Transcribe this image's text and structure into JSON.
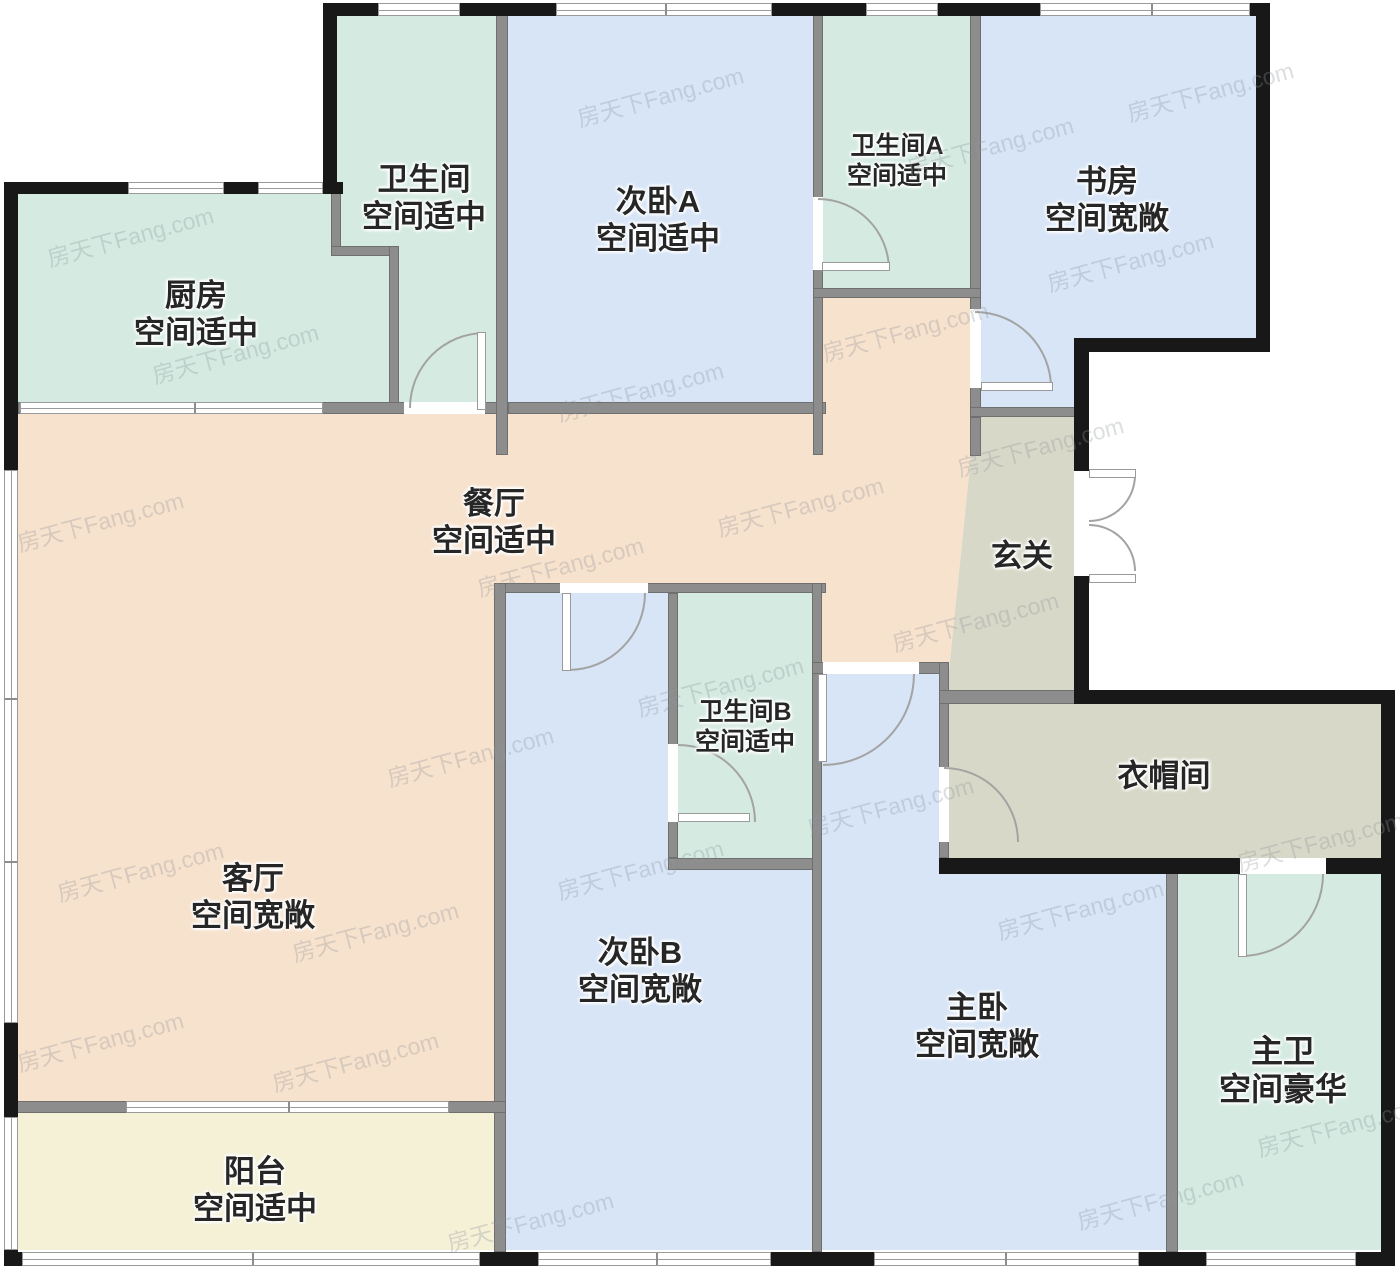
{
  "app": {
    "type": "residential-floor-plan",
    "watermark_text": "房天下Fang.com"
  },
  "canvas": {
    "w": 1400,
    "h": 1269,
    "bg": "#ffffff"
  },
  "palette": {
    "mint": "#d5ebe2",
    "blue": "#d7e5f7",
    "peach": "#f7e2cd",
    "yellow": "#f4f1d7",
    "gray": "#d8d8c8",
    "wall_black": "#181818",
    "wall_gray": "#8d8d8d",
    "door_arc": "#a3a3a3",
    "label_color": "#262626",
    "watermark_color": "#8f959b"
  },
  "regions": [
    {
      "id": "kitchen",
      "color": "mint",
      "kind": "rect",
      "x": 18,
      "y": 192,
      "w": 371,
      "h": 220
    },
    {
      "id": "bathroom-top",
      "color": "mint",
      "kind": "poly",
      "points": [
        [
          337,
          14
        ],
        [
          496,
          14
        ],
        [
          496,
          412
        ],
        [
          399,
          412
        ],
        [
          399,
          251
        ],
        [
          337,
          251
        ]
      ]
    },
    {
      "id": "bedroom-a",
      "color": "blue",
      "kind": "rect",
      "x": 508,
      "y": 16,
      "w": 305,
      "h": 396
    },
    {
      "id": "bathroom-a",
      "color": "mint",
      "kind": "rect",
      "x": 823,
      "y": 16,
      "w": 147,
      "h": 276
    },
    {
      "id": "study",
      "color": "blue",
      "kind": "poly",
      "points": [
        [
          981,
          16
        ],
        [
          1256,
          16
        ],
        [
          1256,
          338
        ],
        [
          1074,
          338
        ],
        [
          1074,
          409
        ],
        [
          981,
          409
        ]
      ]
    },
    {
      "id": "living-dining",
      "color": "peach",
      "kind": "poly",
      "points": [
        [
          18,
          412
        ],
        [
          823,
          412
        ],
        [
          823,
          298
        ],
        [
          975,
          298
        ],
        [
          975,
          417
        ],
        [
          949,
          670
        ],
        [
          822,
          670
        ],
        [
          822,
          583
        ],
        [
          506,
          583
        ],
        [
          506,
          1103
        ],
        [
          18,
          1103
        ]
      ]
    },
    {
      "id": "hallway",
      "color": "gray",
      "kind": "poly",
      "points": [
        [
          975,
          417
        ],
        [
          1074,
          417
        ],
        [
          1074,
          694
        ],
        [
          949,
          694
        ],
        [
          949,
          670
        ]
      ]
    },
    {
      "id": "closet",
      "color": "gray",
      "kind": "rect",
      "x": 949,
      "y": 704,
      "w": 432,
      "h": 154
    },
    {
      "id": "bedroom-b",
      "color": "blue",
      "kind": "poly",
      "points": [
        [
          506,
          593
        ],
        [
          668,
          593
        ],
        [
          668,
          870
        ],
        [
          812,
          870
        ],
        [
          812,
          1250
        ],
        [
          506,
          1250
        ]
      ]
    },
    {
      "id": "bathroom-b",
      "color": "mint",
      "kind": "rect",
      "x": 678,
      "y": 593,
      "w": 134,
      "h": 265
    },
    {
      "id": "master-bedroom",
      "color": "blue",
      "kind": "poly",
      "points": [
        [
          822,
          674
        ],
        [
          939,
          674
        ],
        [
          939,
          874
        ],
        [
          1166,
          874
        ],
        [
          1166,
          1250
        ],
        [
          822,
          1250
        ]
      ]
    },
    {
      "id": "master-bathroom",
      "color": "mint",
      "kind": "rect",
      "x": 1178,
      "y": 874,
      "w": 203,
      "h": 376
    },
    {
      "id": "balcony",
      "color": "yellow",
      "kind": "rect",
      "x": 18,
      "y": 1113,
      "w": 482,
      "h": 137
    }
  ],
  "labels": [
    {
      "id": "kitchen",
      "x": 196,
      "y": 314,
      "fs": 31,
      "lines": [
        "厨房",
        "空间适中"
      ]
    },
    {
      "id": "bathroom-top",
      "x": 424,
      "y": 198,
      "fs": 31,
      "lines": [
        "卫生间",
        "空间适中"
      ]
    },
    {
      "id": "bedroom-a",
      "x": 658,
      "y": 220,
      "fs": 31,
      "lines": [
        "次卧A",
        "空间适中"
      ]
    },
    {
      "id": "bathroom-a",
      "x": 897,
      "y": 161,
      "fs": 25,
      "lines": [
        "卫生间A",
        "空间适中"
      ]
    },
    {
      "id": "study",
      "x": 1107,
      "y": 200,
      "fs": 31,
      "lines": [
        "书房",
        "空间宽敞"
      ]
    },
    {
      "id": "dining",
      "x": 494,
      "y": 522,
      "fs": 31,
      "lines": [
        "餐厅",
        "空间适中"
      ]
    },
    {
      "id": "hallway",
      "x": 1022,
      "y": 556,
      "fs": 31,
      "lines": [
        "玄关"
      ]
    },
    {
      "id": "bathroom-b",
      "x": 745,
      "y": 727,
      "fs": 25,
      "lines": [
        "卫生间B",
        "空间适中"
      ]
    },
    {
      "id": "closet",
      "x": 1164,
      "y": 776,
      "fs": 31,
      "lines": [
        "衣帽间"
      ]
    },
    {
      "id": "living",
      "x": 253,
      "y": 897,
      "fs": 31,
      "lines": [
        "客厅",
        "空间宽敞"
      ]
    },
    {
      "id": "bedroom-b",
      "x": 640,
      "y": 971,
      "fs": 31,
      "lines": [
        "次卧B",
        "空间宽敞"
      ]
    },
    {
      "id": "master-bedroom",
      "x": 977,
      "y": 1026,
      "fs": 31,
      "lines": [
        "主卧",
        "空间宽敞"
      ]
    },
    {
      "id": "master-bathroom",
      "x": 1283,
      "y": 1070,
      "fs": 32,
      "lines": [
        "主卫",
        "空间豪华"
      ]
    },
    {
      "id": "balcony",
      "x": 255,
      "y": 1190,
      "fs": 31,
      "lines": [
        "阳台",
        "空间适中"
      ]
    }
  ],
  "walls": {
    "black": [
      {
        "x": 325,
        "y": 3,
        "w": 945,
        "h": 13
      },
      {
        "x": 4,
        "y": 182,
        "w": 339,
        "h": 12
      },
      {
        "x": 4,
        "y": 182,
        "w": 14,
        "h": 1084
      },
      {
        "x": 4,
        "y": 1252,
        "w": 1391,
        "h": 14
      },
      {
        "x": 323,
        "y": 3,
        "w": 14,
        "h": 190
      },
      {
        "x": 1256,
        "y": 3,
        "w": 14,
        "h": 349
      },
      {
        "x": 1077,
        "y": 338,
        "w": 193,
        "h": 14
      },
      {
        "x": 1074,
        "y": 338,
        "w": 15,
        "h": 133
      },
      {
        "x": 1074,
        "y": 576,
        "w": 15,
        "h": 118
      },
      {
        "x": 1074,
        "y": 690,
        "w": 321,
        "h": 14
      },
      {
        "x": 1381,
        "y": 690,
        "w": 14,
        "h": 576
      },
      {
        "x": 939,
        "y": 858,
        "w": 301,
        "h": 16
      },
      {
        "x": 1326,
        "y": 858,
        "w": 69,
        "h": 16
      }
    ],
    "gray": [
      {
        "x": 331,
        "y": 192,
        "w": 10,
        "h": 59
      },
      {
        "x": 331,
        "y": 246,
        "w": 68,
        "h": 10
      },
      {
        "x": 389,
        "y": 246,
        "w": 10,
        "h": 166
      },
      {
        "x": 18,
        "y": 402,
        "w": 490,
        "h": 12
      },
      {
        "x": 508,
        "y": 402,
        "w": 318,
        "h": 12
      },
      {
        "x": 970,
        "y": 14,
        "w": 11,
        "h": 403
      },
      {
        "x": 970,
        "y": 417,
        "w": 11,
        "h": 39
      },
      {
        "x": 496,
        "y": 14,
        "w": 12,
        "h": 441
      },
      {
        "x": 813,
        "y": 14,
        "w": 10,
        "h": 441
      },
      {
        "x": 813,
        "y": 288,
        "w": 168,
        "h": 10
      },
      {
        "x": 970,
        "y": 407,
        "w": 119,
        "h": 10
      },
      {
        "x": 494,
        "y": 583,
        "w": 332,
        "h": 10
      },
      {
        "x": 494,
        "y": 583,
        "w": 12,
        "h": 669
      },
      {
        "x": 668,
        "y": 593,
        "w": 10,
        "h": 265
      },
      {
        "x": 668,
        "y": 858,
        "w": 154,
        "h": 12
      },
      {
        "x": 812,
        "y": 583,
        "w": 10,
        "h": 669
      },
      {
        "x": 812,
        "y": 662,
        "w": 132,
        "h": 12
      },
      {
        "x": 939,
        "y": 662,
        "w": 10,
        "h": 196
      },
      {
        "x": 1166,
        "y": 862,
        "w": 12,
        "h": 390
      },
      {
        "x": 4,
        "y": 1101,
        "w": 502,
        "h": 12
      },
      {
        "x": 939,
        "y": 690,
        "w": 140,
        "h": 14
      }
    ]
  },
  "windows": [
    {
      "id": "top-bath",
      "x": 378,
      "y": 3,
      "w": 82,
      "h": 13,
      "dir": "h",
      "mullions": []
    },
    {
      "id": "top-bedroom-a",
      "x": 556,
      "y": 3,
      "w": 216,
      "h": 13,
      "dir": "h",
      "mullions": [
        664
      ]
    },
    {
      "id": "top-bath-a",
      "x": 866,
      "y": 3,
      "w": 72,
      "h": 13,
      "dir": "h",
      "mullions": []
    },
    {
      "id": "top-study",
      "x": 1040,
      "y": 3,
      "w": 210,
      "h": 13,
      "dir": "h",
      "mullions": [
        1150
      ]
    },
    {
      "id": "kitchen-top-1",
      "x": 128,
      "y": 182,
      "w": 96,
      "h": 12,
      "dir": "h",
      "mullions": []
    },
    {
      "id": "kitchen-top-2",
      "x": 258,
      "y": 182,
      "w": 65,
      "h": 12,
      "dir": "h",
      "mullions": []
    },
    {
      "id": "left-living",
      "x": 4,
      "y": 470,
      "w": 14,
      "h": 553,
      "dir": "v",
      "mullions": [
        697,
        860
      ]
    },
    {
      "id": "left-balcony",
      "x": 4,
      "y": 1117,
      "w": 14,
      "h": 133,
      "dir": "v",
      "mullions": []
    },
    {
      "id": "kitchen-bottom",
      "x": 20,
      "y": 402,
      "w": 303,
      "h": 12,
      "dir": "h",
      "mullions": [
        193
      ]
    },
    {
      "id": "balcony-divider",
      "x": 126,
      "y": 1101,
      "w": 323,
      "h": 12,
      "dir": "h",
      "mullions": [
        287
      ]
    },
    {
      "id": "bottom-balcony",
      "x": 22,
      "y": 1252,
      "w": 458,
      "h": 14,
      "dir": "h",
      "mullions": [
        251
      ]
    },
    {
      "id": "bottom-bedroom-b",
      "x": 538,
      "y": 1252,
      "w": 233,
      "h": 14,
      "dir": "h",
      "mullions": [
        655
      ]
    },
    {
      "id": "bottom-master",
      "x": 874,
      "y": 1252,
      "w": 265,
      "h": 14,
      "dir": "h",
      "mullions": [
        1004
      ]
    },
    {
      "id": "bottom-master-bath",
      "x": 1206,
      "y": 1252,
      "w": 150,
      "h": 14,
      "dir": "h",
      "mullions": []
    }
  ],
  "door_openings": [
    {
      "id": "bathroom-top-door-gap",
      "x": 404,
      "y": 402,
      "w": 81,
      "h": 12
    },
    {
      "id": "bathroom-a-door-gap",
      "x": 813,
      "y": 197,
      "w": 10,
      "h": 73
    },
    {
      "id": "study-door-gap",
      "x": 970,
      "y": 309,
      "w": 11,
      "h": 79
    },
    {
      "id": "entry-door-gap",
      "x": 1074,
      "y": 471,
      "w": 15,
      "h": 105
    },
    {
      "id": "bedroom-b-door-gap",
      "x": 560,
      "y": 583,
      "w": 88,
      "h": 10
    },
    {
      "id": "bathroom-b-door-gap",
      "x": 668,
      "y": 744,
      "w": 10,
      "h": 78
    },
    {
      "id": "master-door-gap",
      "x": 823,
      "y": 662,
      "w": 96,
      "h": 12
    },
    {
      "id": "closet-door-gap",
      "x": 939,
      "y": 767,
      "w": 10,
      "h": 75
    },
    {
      "id": "master-bath-door-gap",
      "x": 1240,
      "y": 858,
      "w": 86,
      "h": 16
    }
  ],
  "door_arcs": [
    {
      "id": "bathroom-top-door-arc",
      "x": 409,
      "y": 332,
      "w": 76,
      "h": 76,
      "corner": "tl"
    },
    {
      "id": "bathroom-a-door-arc",
      "x": 818,
      "y": 198,
      "w": 72,
      "h": 72,
      "corner": "tr"
    },
    {
      "id": "study-door-arc",
      "x": 975,
      "y": 311,
      "w": 77,
      "h": 77,
      "corner": "tr"
    },
    {
      "id": "entry-door-arc-top",
      "x": 1089,
      "y": 475,
      "w": 47,
      "h": 47,
      "corner": "br"
    },
    {
      "id": "entry-door-arc-bottom",
      "x": 1089,
      "y": 524,
      "w": 47,
      "h": 47,
      "corner": "tr"
    },
    {
      "id": "bedroom-b-door-arc",
      "x": 568,
      "y": 593,
      "w": 78,
      "h": 78,
      "corner": "br"
    },
    {
      "id": "bathroom-b-door-arc",
      "x": 678,
      "y": 744,
      "w": 78,
      "h": 78,
      "corner": "tr"
    },
    {
      "id": "master-door-arc",
      "x": 823,
      "y": 674,
      "w": 92,
      "h": 92,
      "corner": "br"
    },
    {
      "id": "closet-door-arc",
      "x": 944,
      "y": 767,
      "w": 75,
      "h": 75,
      "corner": "tr"
    },
    {
      "id": "master-bath-door-arc",
      "x": 1241,
      "y": 874,
      "w": 83,
      "h": 83,
      "corner": "br"
    }
  ],
  "door_leaves": [
    {
      "id": "bathroom-top-door-leaf",
      "x": 477,
      "y": 332,
      "w": 9,
      "h": 78
    },
    {
      "id": "bathroom-a-door-leaf",
      "x": 822,
      "y": 262,
      "w": 68,
      "h": 9
    },
    {
      "id": "study-door-leaf",
      "x": 981,
      "y": 382,
      "w": 72,
      "h": 9
    },
    {
      "id": "entry-door-leaf-top",
      "x": 1089,
      "y": 469,
      "w": 47,
      "h": 9
    },
    {
      "id": "entry-door-leaf-bottom",
      "x": 1089,
      "y": 574,
      "w": 47,
      "h": 9
    },
    {
      "id": "bedroom-b-door-leaf",
      "x": 562,
      "y": 593,
      "w": 9,
      "h": 78
    },
    {
      "id": "bathroom-b-door-leaf",
      "x": 678,
      "y": 813,
      "w": 72,
      "h": 9
    },
    {
      "id": "master-door-leaf",
      "x": 818,
      "y": 674,
      "w": 9,
      "h": 88
    },
    {
      "id": "master-bath-door-leaf",
      "x": 1238,
      "y": 874,
      "w": 9,
      "h": 83
    }
  ],
  "watermarks": [
    {
      "x": 130,
      "y": 235
    },
    {
      "x": 235,
      "y": 352
    },
    {
      "x": 100,
      "y": 520
    },
    {
      "x": 140,
      "y": 870
    },
    {
      "x": 100,
      "y": 1040
    },
    {
      "x": 375,
      "y": 930
    },
    {
      "x": 530,
      "y": 1220
    },
    {
      "x": 640,
      "y": 390
    },
    {
      "x": 560,
      "y": 565
    },
    {
      "x": 470,
      "y": 755
    },
    {
      "x": 720,
      "y": 685
    },
    {
      "x": 890,
      "y": 805
    },
    {
      "x": 905,
      "y": 330
    },
    {
      "x": 990,
      "y": 145
    },
    {
      "x": 1210,
      "y": 90
    },
    {
      "x": 1130,
      "y": 260
    },
    {
      "x": 1040,
      "y": 445
    },
    {
      "x": 975,
      "y": 620
    },
    {
      "x": 1080,
      "y": 908
    },
    {
      "x": 1160,
      "y": 1198
    },
    {
      "x": 1320,
      "y": 840
    },
    {
      "x": 1340,
      "y": 1125
    },
    {
      "x": 800,
      "y": 505
    },
    {
      "x": 640,
      "y": 868
    },
    {
      "x": 660,
      "y": 95
    },
    {
      "x": 355,
      "y": 1060
    }
  ]
}
